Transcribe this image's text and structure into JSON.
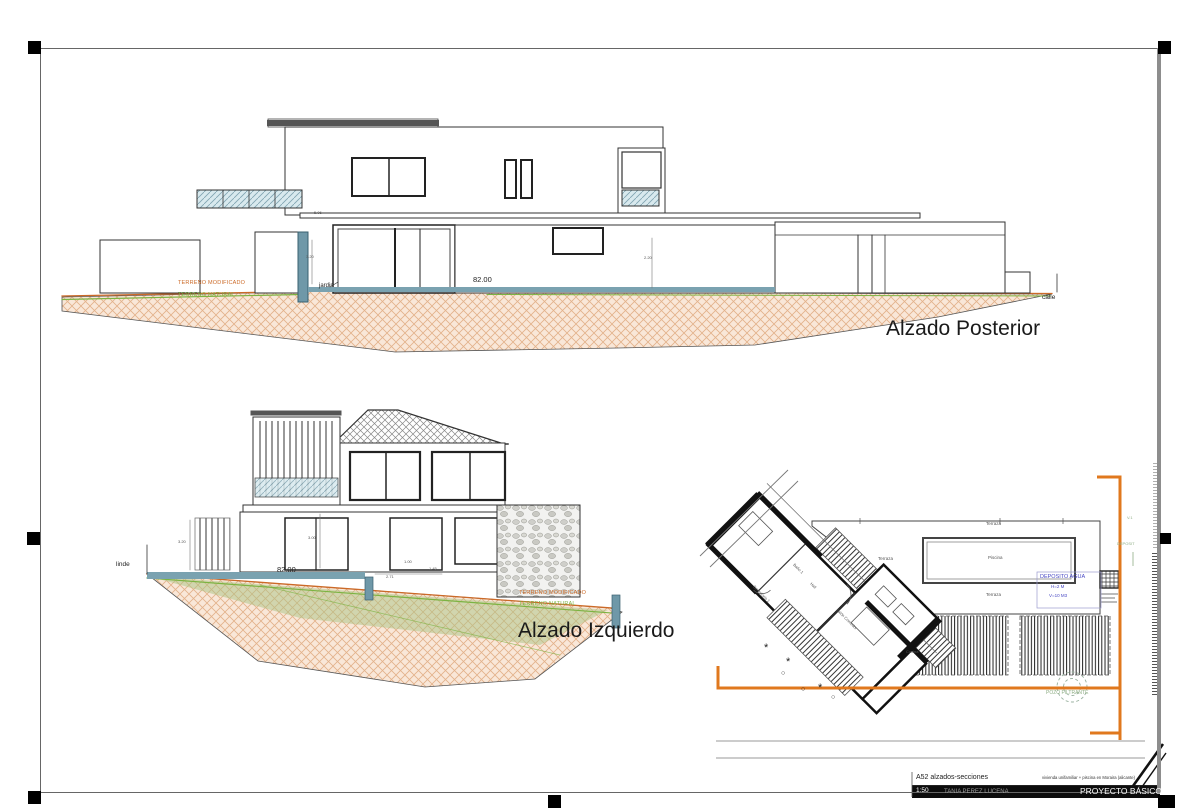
{
  "labels": {
    "alzado_posterior": "Alzado Posterior",
    "alzado_izquierdo": "Alzado Izquierdo"
  },
  "terrain": {
    "modificado_top": "TERRENO MODIFICADO",
    "natural_top": "TERRENO NATURAL",
    "modificado_left": "TERRENO MODIFICADO",
    "natural_left": "TERRENO NATURAL"
  },
  "site": {
    "calle": "calle",
    "jardin": "jardin",
    "linde": "linde"
  },
  "dims": {
    "w_top": "82.00",
    "w_left": "82.00",
    "d506": "5.06",
    "d320_top": "3.20",
    "d220": "2.20",
    "d320_left": "3.20",
    "d300": "3.00",
    "d271": "2.71",
    "d100": "1.00",
    "d145": "1.45"
  },
  "plan": {
    "piscina": "Piscina",
    "terraza_1": "Terraza",
    "terraza_2": "Terraza",
    "terraza_3": "Terraza",
    "cocina": "Cocina",
    "salon_comedor": "Salón Comedor",
    "dormitorio_1": "Dormitorio 1",
    "bano_1": "Baño 1",
    "hall": "Hall",
    "deposito_agua": "DEPOSITO AGUA",
    "deposito_h": "H=2 M",
    "deposito_v": "V=10 M3",
    "pozo_filtrante": "POZO FILTRANTE",
    "deposit": "DEPOSIT",
    "v1": "V.1",
    "star": "*",
    "circle": "○"
  },
  "titleblock": {
    "sheet_code": "A52 alzados-secciones",
    "scale": "1:50",
    "author": "TANIA PEREZ LUCENA",
    "project": "vivienda unifamiliar + piscina en Moraira (alicante)",
    "phase": "PROYECTO BÁSICO"
  },
  "colors": {
    "terrain_fill": "#f9e7d8",
    "terrain_hatch": "#e3b18a",
    "terrain_orange": "#cc6a28",
    "terrain_green": "#7cb342",
    "teal": "#6f98a8",
    "boundary_orange": "#e0781e",
    "blue_note": "#4a4ac4",
    "green_note": "#8fae85"
  }
}
